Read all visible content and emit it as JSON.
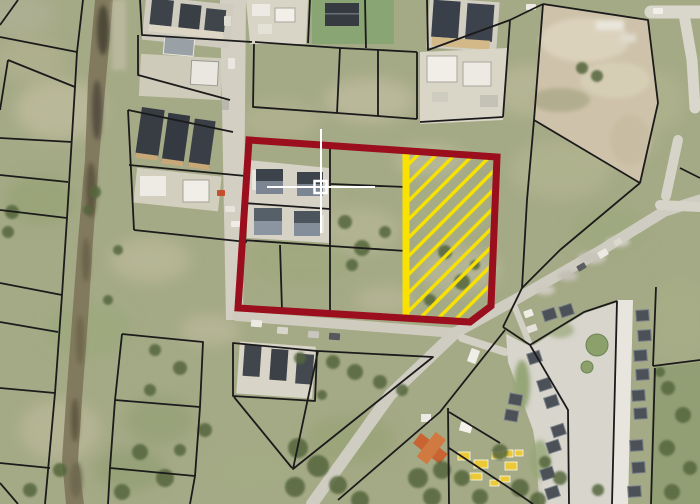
{
  "map": {
    "kind": "aerial-cadastral-map",
    "colors": {
      "grass": "#a5aa86",
      "parcel_line": "#1b1b1b",
      "road": "#cfccc1",
      "road_light": "#e7e5dd",
      "ditch": "#7b7258",
      "dirt": "#cec3aa",
      "construction_ground": "#d7d3c5",
      "pavement": "#d7d5cc",
      "roof_dark": "#3c4147",
      "roof_mid": "#7c8693",
      "tree": "#55663e",
      "materials_yellow": "#ecc937"
    },
    "highlight_parcel": {
      "boundary_color": "#9a0e1d",
      "boundary_width": 7,
      "outline_points": "249,140 497,157 491,306 470,322 238,308"
    },
    "hatch_area": {
      "color": "#f9e200",
      "stripe_width": 7,
      "outline_points": "409,153 493,159 487,304 469,320 409,316"
    },
    "marker": {
      "color": "#ffffff",
      "center_x": 321,
      "center_y": 187
    },
    "scene": {
      "grass_patches": [
        [
          60,
          110,
          45,
          30,
          "#c2bda0",
          0.7
        ],
        [
          40,
          200,
          35,
          25,
          "#93a070",
          0.6
        ],
        [
          150,
          260,
          40,
          22,
          "#c5c1a4",
          0.5
        ],
        [
          90,
          330,
          45,
          28,
          "#9aa87c",
          0.6
        ],
        [
          60,
          430,
          40,
          30,
          "#c0bc9e",
          0.6
        ],
        [
          160,
          420,
          35,
          25,
          "#8e9c6e",
          0.5
        ],
        [
          280,
          120,
          40,
          20,
          "#b9b795",
          0.5
        ],
        [
          370,
          100,
          45,
          22,
          "#c6c2a6",
          0.6
        ],
        [
          300,
          260,
          50,
          25,
          "#9ba877",
          0.5
        ],
        [
          360,
          230,
          40,
          22,
          "#c2bfa0",
          0.45
        ],
        [
          450,
          210,
          45,
          28,
          "#a8b084",
          0.5
        ],
        [
          460,
          270,
          40,
          22,
          "#c4c0a3",
          0.5
        ],
        [
          560,
          170,
          50,
          30,
          "#b6b894",
          0.55
        ],
        [
          610,
          230,
          40,
          25,
          "#9aa87a",
          0.5
        ],
        [
          530,
          90,
          40,
          25,
          "#c3bfa1",
          0.5
        ],
        [
          620,
          140,
          35,
          22,
          "#c0bc9e",
          0.5
        ],
        [
          350,
          440,
          45,
          25,
          "#93a171",
          0.55
        ],
        [
          250,
          470,
          40,
          22,
          "#a2ad82",
          0.5
        ],
        [
          130,
          470,
          35,
          22,
          "#8b996b",
          0.55
        ],
        [
          30,
          60,
          35,
          22,
          "#b7b593",
          0.5
        ],
        [
          680,
          320,
          30,
          40,
          "#a9b287",
          0.5
        ],
        [
          430,
          160,
          35,
          15,
          "#cbc7ab",
          0.45
        ],
        [
          210,
          330,
          30,
          15,
          "#c6c2a6",
          0.5
        ],
        [
          660,
          100,
          25,
          30,
          "#b4b791",
          0.5
        ],
        [
          15,
          15,
          40,
          20,
          "#b2b29a",
          0.6
        ],
        [
          300,
          200,
          40,
          18,
          "#b0b28d",
          0.5
        ],
        [
          385,
          300,
          30,
          14,
          "#c0bda0",
          0.5
        ]
      ],
      "trees": [
        [
          345,
          222,
          7
        ],
        [
          362,
          248,
          8
        ],
        [
          385,
          232,
          6
        ],
        [
          352,
          265,
          6
        ],
        [
          445,
          252,
          7
        ],
        [
          462,
          282,
          8
        ],
        [
          430,
          300,
          6
        ],
        [
          475,
          265,
          5
        ],
        [
          333,
          362,
          7
        ],
        [
          355,
          372,
          8
        ],
        [
          380,
          382,
          7
        ],
        [
          402,
          390,
          6
        ],
        [
          300,
          358,
          6
        ],
        [
          322,
          395,
          5
        ],
        [
          298,
          448,
          10
        ],
        [
          318,
          466,
          11
        ],
        [
          295,
          487,
          10
        ],
        [
          338,
          485,
          9
        ],
        [
          360,
          500,
          9
        ],
        [
          418,
          478,
          10
        ],
        [
          442,
          470,
          9
        ],
        [
          462,
          478,
          8
        ],
        [
          500,
          452,
          8
        ],
        [
          520,
          488,
          9
        ],
        [
          538,
          500,
          8
        ],
        [
          432,
          497,
          9
        ],
        [
          480,
          497,
          8
        ],
        [
          95,
          192,
          6
        ],
        [
          88,
          210,
          5
        ],
        [
          12,
          212,
          7
        ],
        [
          8,
          232,
          6
        ],
        [
          140,
          452,
          8
        ],
        [
          165,
          478,
          9
        ],
        [
          122,
          492,
          8
        ],
        [
          60,
          470,
          7
        ],
        [
          30,
          490,
          7
        ],
        [
          582,
          68,
          6
        ],
        [
          597,
          76,
          6
        ],
        [
          668,
          388,
          7
        ],
        [
          683,
          415,
          8
        ],
        [
          667,
          448,
          8
        ],
        [
          690,
          468,
          7
        ],
        [
          672,
          492,
          8
        ],
        [
          660,
          372,
          5
        ],
        [
          545,
          462,
          6
        ],
        [
          560,
          478,
          7
        ],
        [
          598,
          490,
          6
        ],
        [
          155,
          350,
          6
        ],
        [
          180,
          368,
          7
        ],
        [
          150,
          390,
          6
        ],
        [
          205,
          430,
          7
        ],
        [
          180,
          450,
          6
        ],
        [
          118,
          250,
          5
        ],
        [
          108,
          300,
          5
        ]
      ],
      "vehicles": [
        [
          224,
          16,
          7,
          10,
          "#dedbd2",
          0
        ],
        [
          228,
          58,
          7,
          11,
          "#e9e7e0",
          0
        ],
        [
          222,
          100,
          7,
          10,
          "#b9b7ae",
          0
        ],
        [
          251,
          320,
          11,
          7,
          "#eceae3",
          4
        ],
        [
          277,
          327,
          11,
          7,
          "#d8d5cc",
          4
        ],
        [
          308,
          331,
          11,
          7,
          "#c9c6bd",
          4
        ],
        [
          329,
          333,
          11,
          7,
          "#55595e",
          4
        ],
        [
          469,
          349,
          9,
          14,
          "#f0eee8",
          20
        ],
        [
          598,
          250,
          10,
          7,
          "#eceae4",
          -30
        ],
        [
          577,
          264,
          9,
          6,
          "#5a5e63",
          -30
        ],
        [
          614,
          239,
          8,
          6,
          "#dcd9d0",
          -30
        ],
        [
          653,
          8,
          10,
          6,
          "#f1efe9",
          0
        ],
        [
          526,
          4,
          10,
          6,
          "#eceae3",
          0
        ],
        [
          524,
          310,
          9,
          7,
          "#efede6",
          -20
        ],
        [
          527,
          325,
          10,
          7,
          "#e4e2da",
          -20
        ],
        [
          217,
          190,
          8,
          6,
          "#c4502e",
          0
        ],
        [
          225,
          206,
          10,
          6,
          "#e6e4dc",
          0
        ],
        [
          231,
          221,
          10,
          6,
          "#efede6",
          0
        ]
      ],
      "estate_houses": [
        [
          543,
          309,
          -18
        ],
        [
          560,
          305,
          -18
        ],
        [
          528,
          352,
          -18
        ],
        [
          538,
          379,
          -18
        ],
        [
          545,
          396,
          -18
        ],
        [
          552,
          425,
          -18
        ],
        [
          547,
          441,
          -18
        ],
        [
          541,
          468,
          -18
        ],
        [
          546,
          487,
          -18
        ],
        [
          636,
          310,
          -4
        ],
        [
          638,
          330,
          -4
        ],
        [
          634,
          350,
          -4
        ],
        [
          636,
          369,
          -4
        ],
        [
          632,
          390,
          -4
        ],
        [
          634,
          408,
          -4
        ],
        [
          630,
          440,
          -4
        ],
        [
          632,
          462,
          -4
        ],
        [
          628,
          486,
          -4
        ],
        [
          505,
          410,
          10
        ],
        [
          509,
          394,
          10
        ]
      ],
      "estate_circles": [
        [
          597,
          345,
          11
        ],
        [
          587,
          367,
          6
        ]
      ],
      "yellow_materials": [
        [
          458,
          452,
          12,
          8
        ],
        [
          474,
          460,
          14,
          8
        ],
        [
          492,
          452,
          12,
          7
        ],
        [
          505,
          462,
          12,
          8
        ],
        [
          470,
          473,
          12,
          7
        ],
        [
          500,
          476,
          10,
          6
        ],
        [
          515,
          450,
          8,
          6
        ],
        [
          503,
          450,
          10,
          7
        ],
        [
          490,
          480,
          9,
          6
        ]
      ]
    }
  }
}
